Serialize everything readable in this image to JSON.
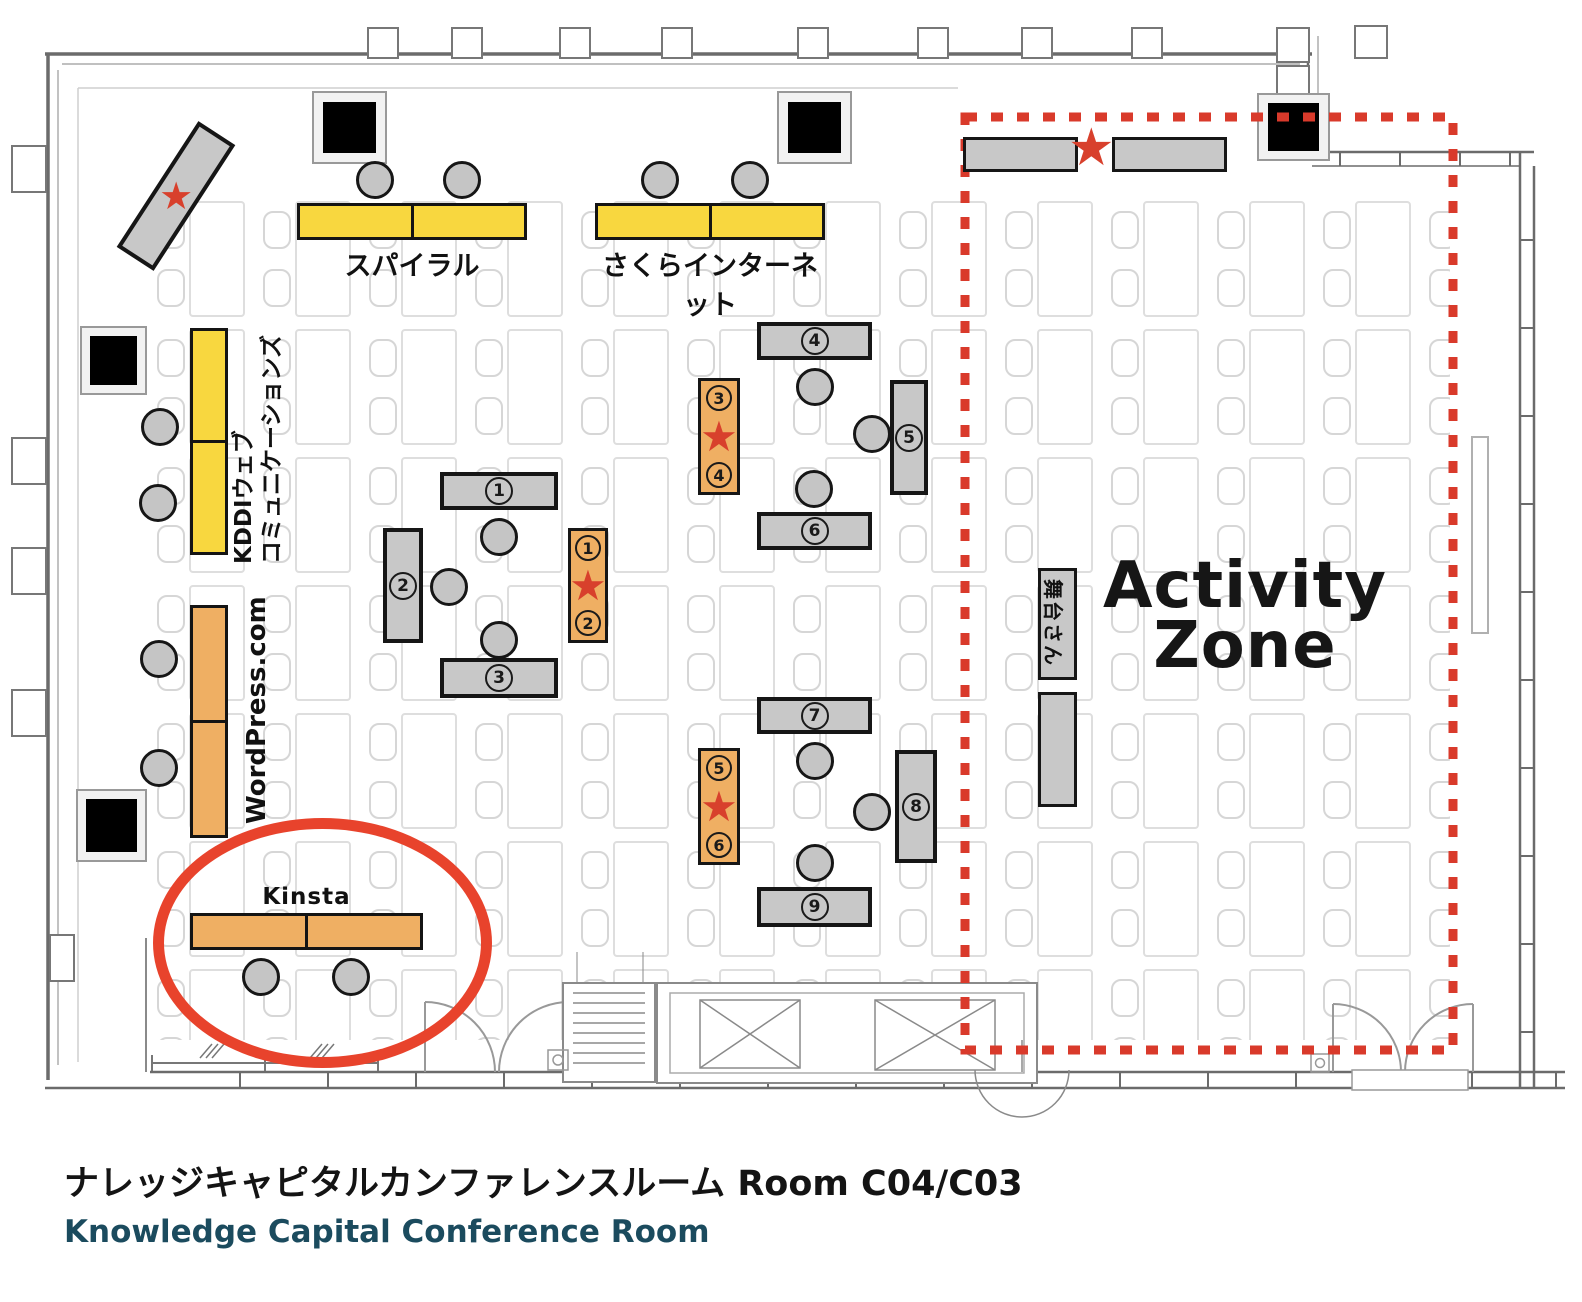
{
  "plan": {
    "activity_zone": {
      "line1": "Activity",
      "line2": "Zone"
    },
    "star_glyph": "★",
    "booths": {
      "spiral": {
        "label": "スパイラル"
      },
      "sakura": {
        "label": "さくらインターネット"
      },
      "kddi": {
        "line1": "KDDIウェブ",
        "line2": "コミュニケーションズ"
      },
      "wordpress": {
        "label": "WordPress.com"
      },
      "kinsta": {
        "label": "Kinsta"
      },
      "stage": {
        "label": "舞台さん"
      }
    },
    "tables": {
      "t1": "1",
      "t2": "2",
      "t3": "3",
      "t4": "4",
      "t5": "5",
      "t6": "6",
      "t7": "7",
      "t8": "8",
      "t9": "9",
      "o1a": "1",
      "o1b": "2",
      "o2a": "3",
      "o2b": "4",
      "o3a": "5",
      "o3b": "6"
    }
  },
  "footer": {
    "title_jp": "ナレッジキャピタルカンファレンスルーム Room C04/C03",
    "title_en": "Knowledge Capital Conference Room"
  },
  "colors": {
    "booth_yellow": "#F8D73F",
    "booth_orange": "#EFAF63",
    "table_gray": "#C8C8C8",
    "accent_red": "#D93A2B",
    "title_en_color": "#1B4B5E"
  }
}
